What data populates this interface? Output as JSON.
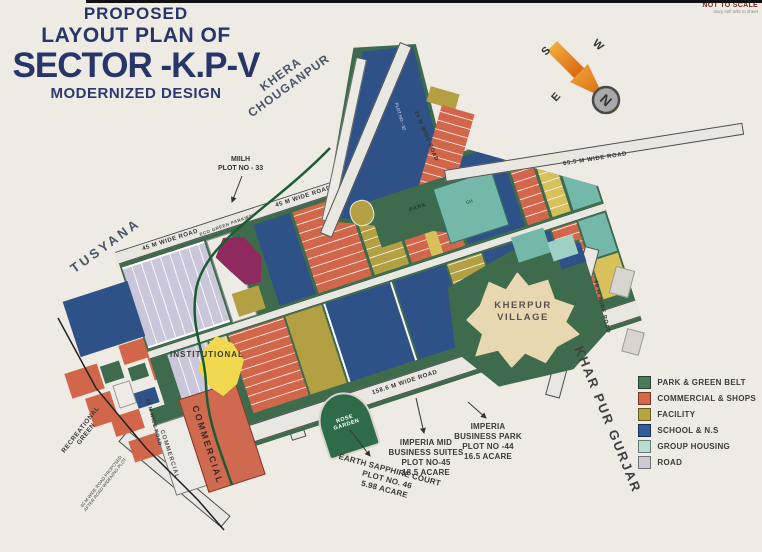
{
  "title": {
    "proposed": "PROPOSED",
    "layout_plan": "LAYOUT PLAN OF",
    "sector": "SECTOR -K.P-V",
    "modernized": "MODERNIZED DESIGN"
  },
  "corner_note": {
    "line1": "NOT TO SCALE",
    "line2": "story self tells to sheet"
  },
  "compass": {
    "north": "N",
    "south": "S",
    "east": "E",
    "west": "W"
  },
  "map_labels": {
    "tusyana": "TUSYANA",
    "khera_line1": "KHERA",
    "khera_line2": "CHOUGANPUR",
    "kherpur_line1": "KHERPUR",
    "kherpur_line2": "VILLAGE",
    "khar_pur_gurjar": "KHAR PUR GURJAR",
    "recreational_line1": "RECREATIONAL",
    "recreational_line2": "GREEN",
    "institutional": "INSTITUTIONAL",
    "commercial_main": "COMMERCIAL",
    "commercial_small": "COMMERCIAL",
    "park": "PARK",
    "school": "SCHOOL",
    "rose_line1": "ROSE",
    "rose_line2": "GARDEN",
    "miilh_line1": "MIILH",
    "miilh_line2": "PLOT NO - 33",
    "plot32": "PLOT NO - 32",
    "gh": "GH",
    "proposed_line1": "60 M WIDE ROAD PROPOSED",
    "proposed_line2": "AFTER ROAD WIDENING PLOT"
  },
  "roads": {
    "wide45": "45 M WIDE ROAD",
    "wide45_b": "45 M WIDE ROAD",
    "wide45_c": "45 M WIDE ROAD",
    "wide655": "65.5 M WIDE ROAD",
    "wide24": "24 M WIDE ROAD",
    "wide60": "60 M WIDE ROAD",
    "wide1586_a": "158.6 M WIDE ROAD",
    "wide1586_b": "158.6 M WIDE ROAD",
    "eco": "ECO GREEN PARKWAY"
  },
  "annotations": {
    "earth_sapphire": {
      "line1": "EARTH SAPPHIRE COURT",
      "line2": "PLOT NO. 46",
      "line3": "5.98 ACARE"
    },
    "imperia_mid": {
      "line1": "IMPERIA MID",
      "line2": "BUSINESS SUITES",
      "line3": "PLOT NO-45",
      "line4": "18.5 ACARE"
    },
    "imperia_park": {
      "line1": "IMPERIA",
      "line2": "BUSINESS PARK",
      "line3": "PLOT NO -44",
      "line4": "16.5 ACARE"
    }
  },
  "legend": {
    "items": [
      {
        "label": "PARK & GREEN BELT",
        "color": "#4a7a57"
      },
      {
        "label": "COMMERCIAL & SHOPS",
        "color": "#d4664a"
      },
      {
        "label": "FACILITY",
        "color": "#b8a342"
      },
      {
        "label": "SCHOOL & N.S",
        "color": "#315e9a"
      },
      {
        "label": "GROUP HOUSING",
        "color": "#b7ddd2"
      },
      {
        "label": "ROAD",
        "color": "#cdcad6"
      }
    ]
  }
}
